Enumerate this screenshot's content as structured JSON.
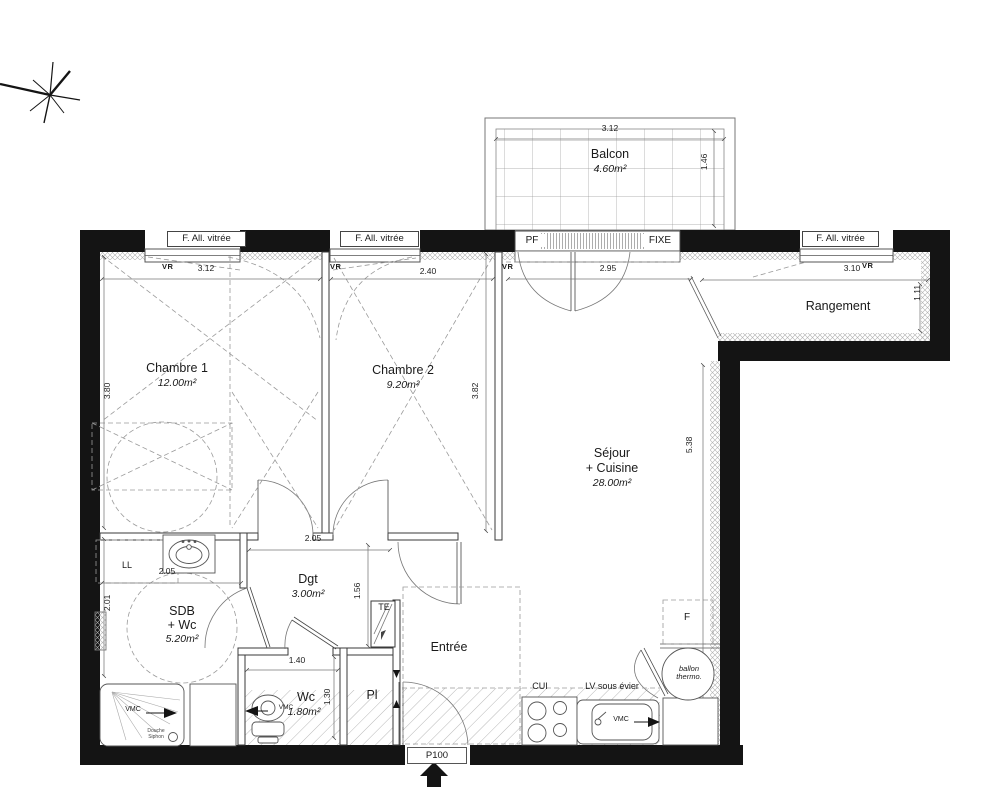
{
  "rooms": {
    "balcon": {
      "name": "Balcon",
      "area": "4.60m²"
    },
    "chambre1": {
      "name": "Chambre 1",
      "area": "12.00m²"
    },
    "chambre2": {
      "name": "Chambre 2",
      "area": "9.20m²"
    },
    "sejour": {
      "name": "Séjour",
      "name2": "+ Cuisine",
      "area": "28.00m²"
    },
    "rangement": {
      "name": "Rangement"
    },
    "sdb": {
      "name": "SDB",
      "name2": "+ Wc",
      "area": "5.20m²"
    },
    "dgt": {
      "name": "Dgt",
      "area": "3.00m²"
    },
    "entree": {
      "name": "Entrée"
    },
    "wc": {
      "name": "Wc",
      "area": "1.80m²"
    },
    "pl": {
      "name": "Pl"
    }
  },
  "openings": {
    "window_label": "F. All. vitrée",
    "pf": "PF",
    "fixe": "FIXE",
    "vr": "VR",
    "entry_door": "P100"
  },
  "equipment": {
    "ll": "LL",
    "te": "TE",
    "fridge": "F",
    "ballon_line1": "ballon",
    "ballon_line2": "thermo.",
    "cui": "CUI",
    "lv": "LV sous évier",
    "vmc": "VMC",
    "douche_line1": "Douche",
    "douche_line2": "Siphon"
  },
  "dimensions": {
    "balcon_w": "3.12",
    "balcon_d": "1.46",
    "ch1_w": "3.12",
    "ch1_h": "3.80",
    "ch2_w": "2.40",
    "ch2_h": "3.82",
    "sejour_w": "2.95",
    "sejour_h": "5.38",
    "rangement_w": "3.10",
    "rangement_d": "1.11",
    "sdb_w": "2.05",
    "sdb_h": "2.01",
    "dgt_w": "2.05",
    "dgt_h": "1.56",
    "wc_w": "1.40",
    "wc_h": "1.30"
  },
  "colors": {
    "wall": "#141414",
    "line": "#666",
    "dashed": "#9a9a9a"
  }
}
